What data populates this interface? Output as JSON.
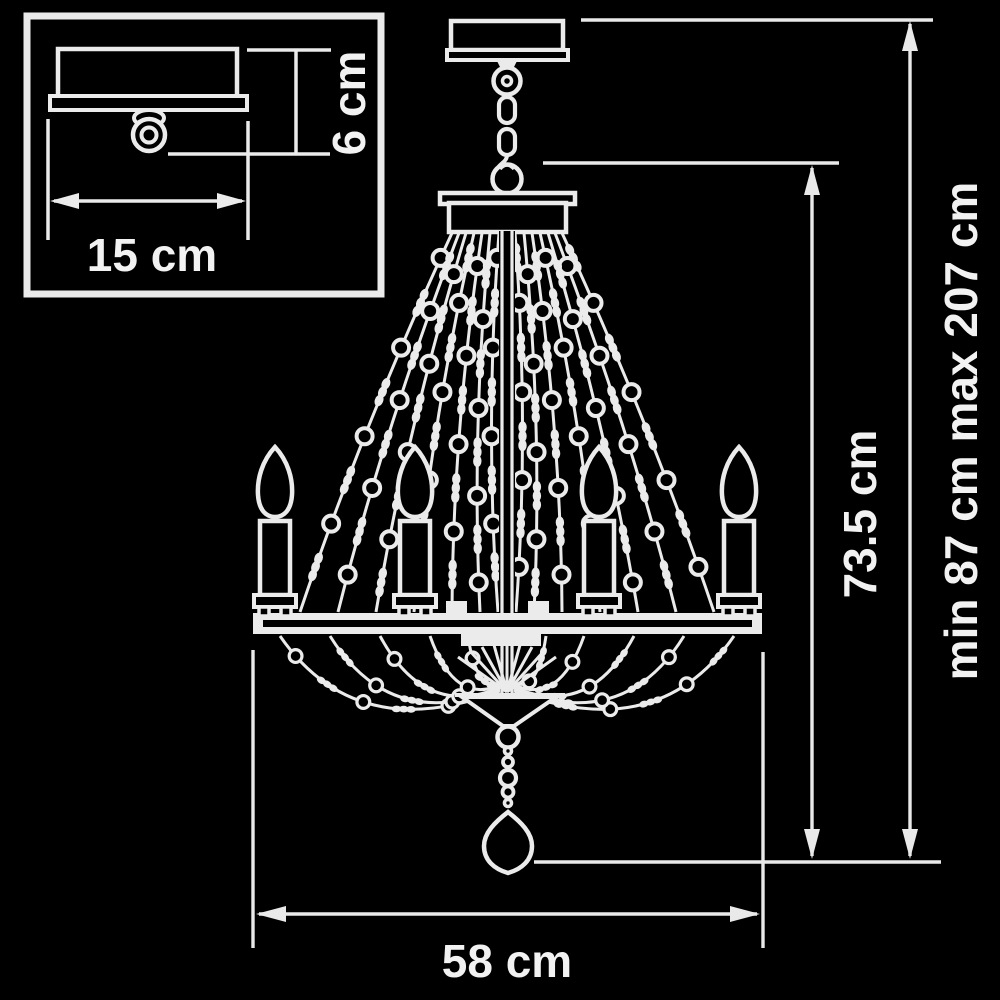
{
  "colors": {
    "background": "#000000",
    "line": "#ebebeb",
    "text": "#f2f2f2"
  },
  "inset": {
    "description": "ceiling-mount-detail-view",
    "width_label": "15 cm",
    "height_label": "6 cm"
  },
  "main": {
    "description": "chandelier-front-view",
    "body_height_label": "73.5 cm",
    "overall_height_label": "min 87 cm max 207 cm",
    "diameter_label": "58 cm"
  }
}
